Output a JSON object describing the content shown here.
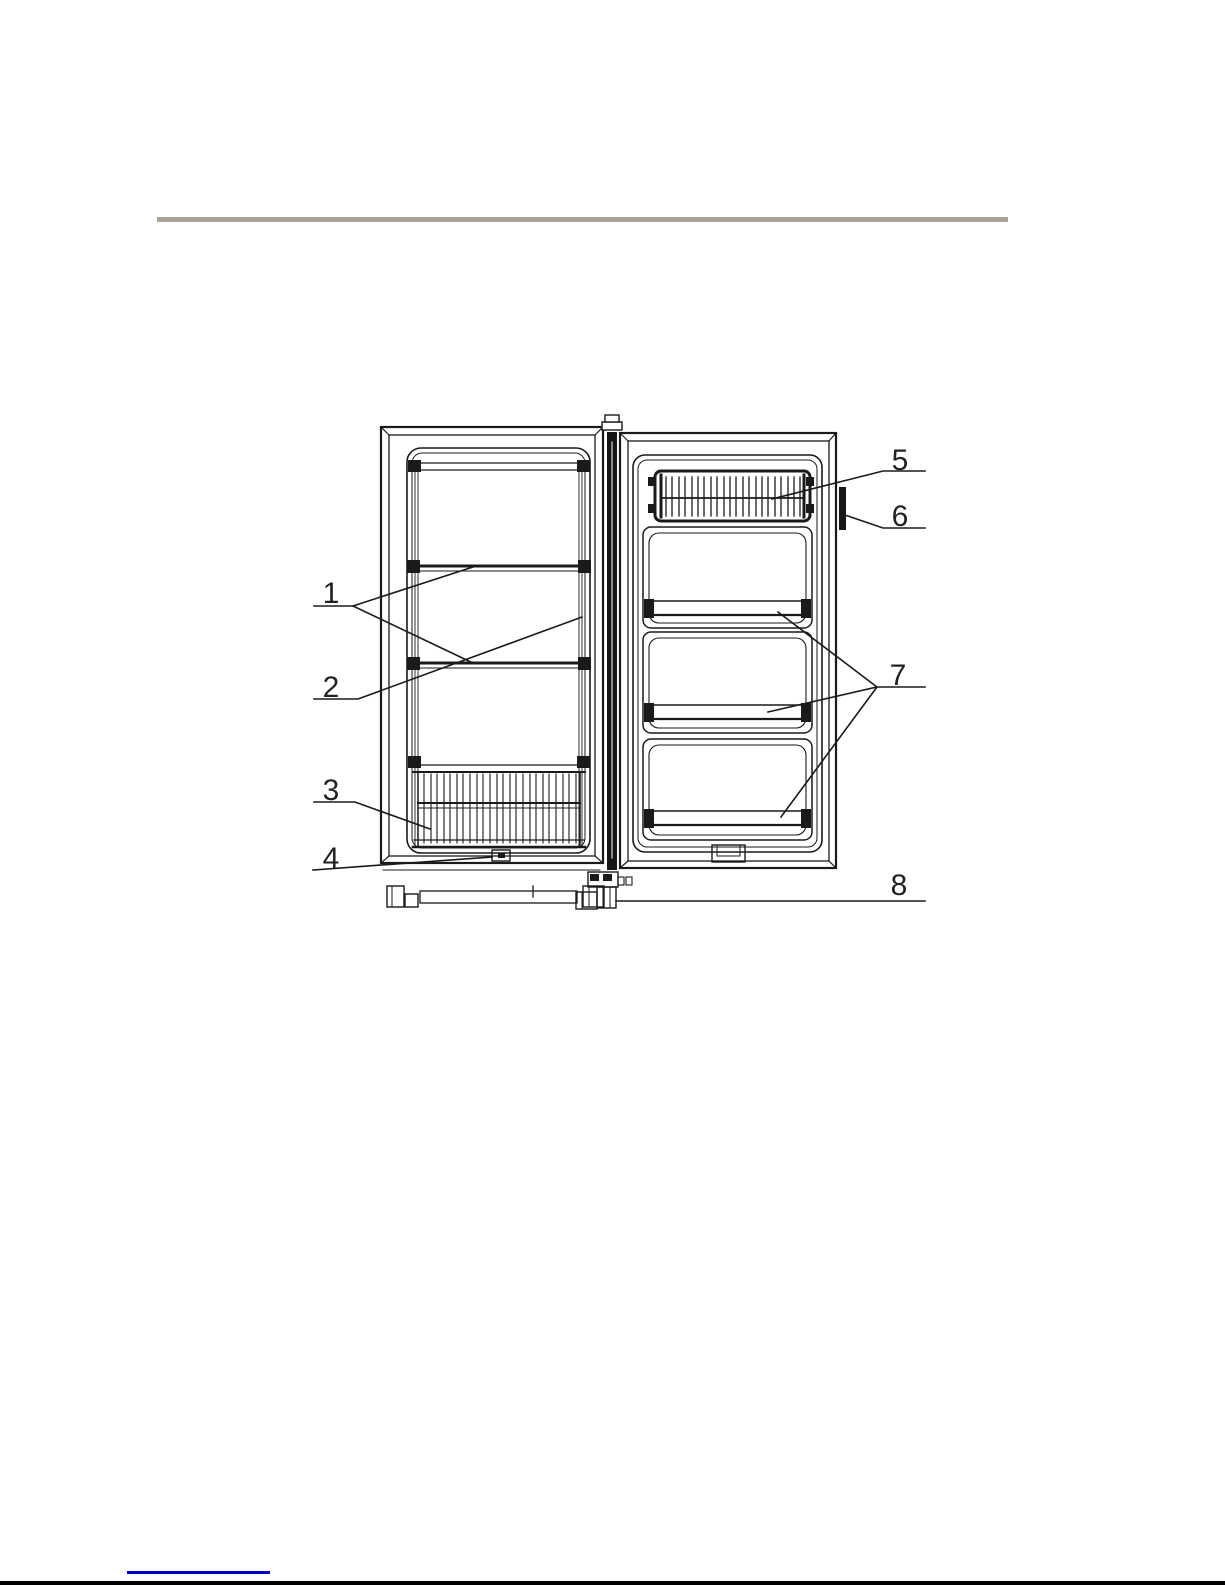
{
  "page": {
    "background_color": "#ffffff",
    "header_rule_color": "#a9a396",
    "footer_link_color": "#0000cc",
    "footer_rule_color": "#000000"
  },
  "figure": {
    "type": "line-drawing",
    "description": "Upright freezer shown with door open: cabinet with shelves and bottom wire basket on the left, inner door with top wire rack and three door bins on the right",
    "stroke_color": "#1a1a1a",
    "callouts": [
      {
        "label": "1"
      },
      {
        "label": "2"
      },
      {
        "label": "3"
      },
      {
        "label": "4"
      },
      {
        "label": "5"
      },
      {
        "label": "6"
      },
      {
        "label": "7"
      },
      {
        "label": "8"
      }
    ]
  }
}
